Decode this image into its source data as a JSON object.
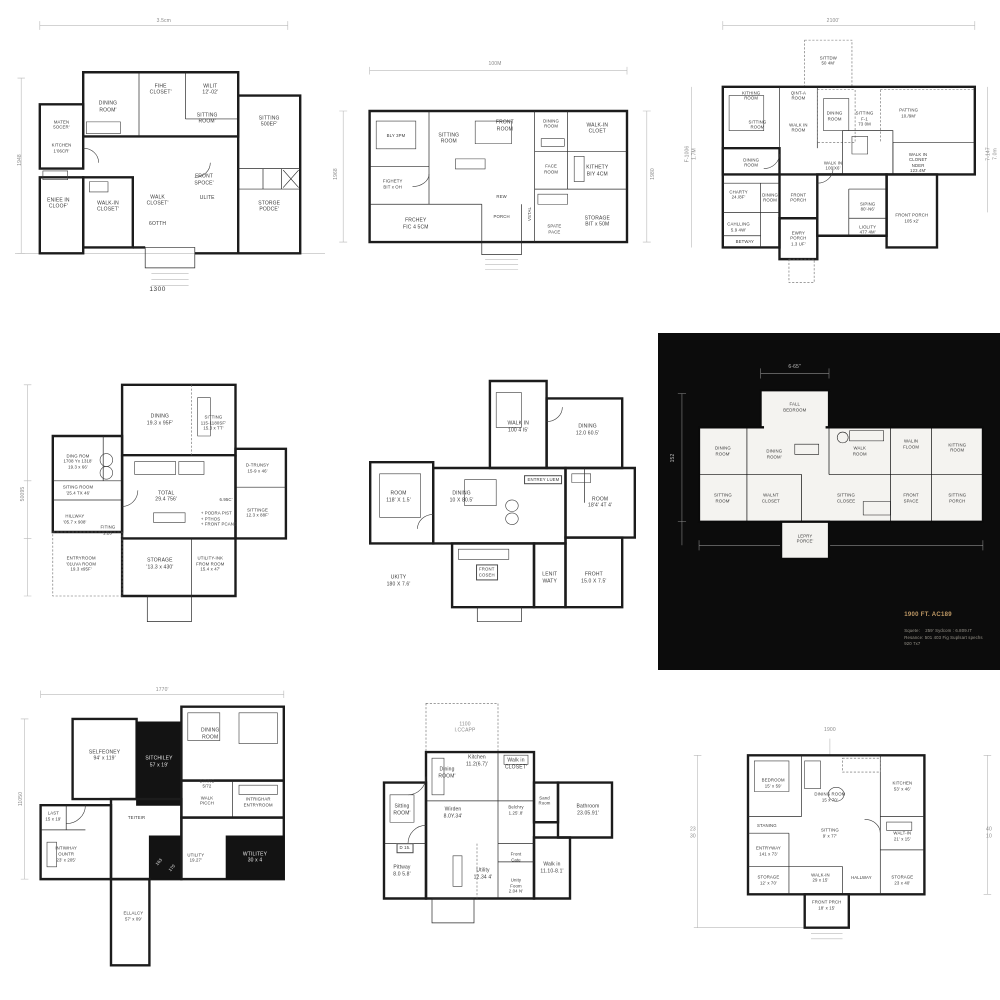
{
  "colors": {
    "ink": "#1c1c1c",
    "paper": "#ffffff",
    "dark_card_bg": "#0c0c0c",
    "dark_caption_accent": "#c09a66"
  },
  "plans": [
    {
      "id": "floorplan-1300",
      "labels": [
        {
          "t": "3.5cm",
          "x": 48,
          "y": 4.5,
          "c": "dim"
        },
        {
          "t": "1948",
          "x": 1.5,
          "y": 52,
          "c": "dim dimv"
        },
        {
          "t": "1300",
          "x": 46,
          "y": 96.5,
          "c": "cap"
        },
        {
          "t": "MATEN\n5OCER'",
          "x": 15,
          "y": 40,
          "c": "sm"
        },
        {
          "t": "KITCHEN\n1'06CR'",
          "x": 15,
          "y": 48,
          "c": "sm"
        },
        {
          "t": "DINING\nROOM'",
          "x": 30,
          "y": 34
        },
        {
          "t": "FIHE\nCLOSET'",
          "x": 47,
          "y": 28
        },
        {
          "t": "WILIT\n12'-02'",
          "x": 63,
          "y": 28
        },
        {
          "t": "SITTING\nROOM'",
          "x": 62,
          "y": 38
        },
        {
          "t": "SITTING\n500EF'",
          "x": 82,
          "y": 39
        },
        {
          "t": "ENIEE IN\nCLOOF'",
          "x": 14,
          "y": 67
        },
        {
          "t": "WALK-IN\nCLOSET'",
          "x": 30,
          "y": 68
        },
        {
          "t": "WALK\nCLOSET'",
          "x": 46,
          "y": 66
        },
        {
          "t": "6OTTH",
          "x": 46,
          "y": 74
        },
        {
          "t": "FRONT\nSPOCE'",
          "x": 61,
          "y": 59
        },
        {
          "t": "ULITE",
          "x": 62,
          "y": 65
        },
        {
          "t": "STORGE\nPODCE'",
          "x": 82,
          "y": 68
        }
      ]
    },
    {
      "id": "floorplan-100m",
      "labels": [
        {
          "t": "100M",
          "x": 50,
          "y": 6.5,
          "c": "dim"
        },
        {
          "t": "1968",
          "x": 1.8,
          "y": 50,
          "c": "dim dimv"
        },
        {
          "t": "1980",
          "x": 98,
          "y": 50,
          "c": "dim dimv"
        },
        {
          "t": "BLY 3PM",
          "x": 20,
          "y": 35,
          "c": "sm"
        },
        {
          "t": "SITTING\nROOM",
          "x": 36,
          "y": 36
        },
        {
          "t": "FRONT\nROOM",
          "x": 53,
          "y": 31
        },
        {
          "t": "DINING\nROOM",
          "x": 67,
          "y": 30,
          "c": "sm"
        },
        {
          "t": "WALK-IN\nCLOET",
          "x": 81,
          "y": 32
        },
        {
          "t": "FIGHETY\nBIT x OH",
          "x": 19,
          "y": 54,
          "c": "sm"
        },
        {
          "t": "FACE\nROOM",
          "x": 67,
          "y": 48,
          "c": "sm"
        },
        {
          "t": "KITHETY\nBIY 4CM",
          "x": 81,
          "y": 49
        },
        {
          "t": "FRCHEY\nFIC 4 5CM",
          "x": 26,
          "y": 70
        },
        {
          "t": "REW",
          "x": 52,
          "y": 59,
          "c": "sm"
        },
        {
          "t": "PORCH",
          "x": 52,
          "y": 67,
          "c": "sm"
        },
        {
          "t": "VSTAL",
          "x": 60.5,
          "y": 66,
          "c": "sm dimv"
        },
        {
          "t": "SPATE\nPACE",
          "x": 68,
          "y": 72,
          "c": "sm"
        },
        {
          "t": "STORAGE\nBIT x 50M",
          "x": 81,
          "y": 69
        }
      ]
    },
    {
      "id": "floorplan-2100",
      "labels": [
        {
          "t": "2100'",
          "x": 47,
          "y": 4.5,
          "c": "dim"
        },
        {
          "t": "F-1006\n1.7M",
          "x": 2,
          "y": 50,
          "c": "dim dimv sm"
        },
        {
          "t": "7-147\n7.0m",
          "x": 97.5,
          "y": 50,
          "c": "dim dimv sm"
        },
        {
          "t": "SITTDW\n50 4M'",
          "x": 45.5,
          "y": 18,
          "c": "sm"
        },
        {
          "t": "KITHING\nROOM",
          "x": 21,
          "y": 30,
          "c": "sm"
        },
        {
          "t": "QINT-A\nROOM",
          "x": 36,
          "y": 30,
          "c": "sm"
        },
        {
          "t": "SITTING\nROOM",
          "x": 23,
          "y": 40,
          "c": "sm"
        },
        {
          "t": "WALK IN\nROOM",
          "x": 36,
          "y": 41,
          "c": "sm"
        },
        {
          "t": "DINING\nROOM",
          "x": 47.5,
          "y": 37,
          "c": "sm"
        },
        {
          "t": "SITTING\nF-1\n73 0M",
          "x": 57,
          "y": 38,
          "c": "sm"
        },
        {
          "t": "PATTING\n10./9M'",
          "x": 71,
          "y": 36,
          "c": "sm"
        },
        {
          "t": "DINING\nROOM",
          "x": 21,
          "y": 53,
          "c": "sm"
        },
        {
          "t": "WALK IN\n100'X6'",
          "x": 47,
          "y": 54,
          "c": "sm"
        },
        {
          "t": "WALK IN\nCLONET\nNDER\n123.4M'",
          "x": 74,
          "y": 53,
          "c": "sm"
        },
        {
          "t": "CHARTY\n24./8F'",
          "x": 17,
          "y": 64,
          "c": "sm"
        },
        {
          "t": "DINING\nROOM",
          "x": 27,
          "y": 65,
          "c": "sm"
        },
        {
          "t": "FRONT\nPORCH",
          "x": 36,
          "y": 65,
          "c": "sm"
        },
        {
          "t": "CAHLLING\n5.9 4W'",
          "x": 17,
          "y": 75,
          "c": "sm"
        },
        {
          "t": "BETWAY",
          "x": 19,
          "y": 80,
          "c": "sm"
        },
        {
          "t": "SIPING\n80'-N6'",
          "x": 58,
          "y": 68,
          "c": "sm"
        },
        {
          "t": "LIOLITY\n477 4M'",
          "x": 58,
          "y": 76,
          "c": "sm"
        },
        {
          "t": "FRONT PORCH\n105 x2'",
          "x": 72,
          "y": 72,
          "c": "sm"
        },
        {
          "t": "EWRY\nPORCH\n1.3 UF'",
          "x": 36,
          "y": 79,
          "c": "sm"
        }
      ]
    },
    {
      "id": "floorplan-total",
      "labels": [
        {
          "t": "50095",
          "x": 2.5,
          "y": 48,
          "c": "dim dimv"
        },
        {
          "t": "DINING\n19.3 x 95F'",
          "x": 46,
          "y": 25
        },
        {
          "t": "SITTING\n115-1180SF'\n15.3 x TT'",
          "x": 63,
          "y": 26,
          "c": "sm"
        },
        {
          "t": "DING ROM\n1708 Yx 1318'\n19.3 x 66'",
          "x": 20,
          "y": 38,
          "c": "sm"
        },
        {
          "t": "SITING ROOM\n'25.4 TX 46'",
          "x": 20,
          "y": 47,
          "c": "sm"
        },
        {
          "t": "HILLWAY\n'05.7 x 908'",
          "x": 19,
          "y": 56,
          "c": "sm"
        },
        {
          "t": "FITING\n1.23'",
          "x": 29.5,
          "y": 59.5,
          "c": "sm"
        },
        {
          "t": "TOTAL\n29.4 756'",
          "x": 48,
          "y": 49
        },
        {
          "t": "6.95C'",
          "x": 67,
          "y": 50,
          "c": "sm"
        },
        {
          "t": "+ PODRA PIST\n+ PTHOS\n+ FRONT PCANS",
          "x": 59,
          "y": 56,
          "c": "sm left"
        },
        {
          "t": "D-TRUNSY\n15-9 x 46'",
          "x": 77,
          "y": 40,
          "c": "sm"
        },
        {
          "t": "SITTINGE\n12.3 x 88F'",
          "x": 77,
          "y": 54,
          "c": "sm"
        },
        {
          "t": "ENTRYROOM\n'01UVA ROOM\n19.3 x95F'",
          "x": 21,
          "y": 70,
          "c": "sm"
        },
        {
          "t": "STORAGE\n'13.3 x 430'",
          "x": 46,
          "y": 70
        },
        {
          "t": "UTILITY-INK\nFROM ROOM\n15.4 x 47'",
          "x": 62,
          "y": 70,
          "c": "sm"
        }
      ]
    },
    {
      "id": "floorplan-entrey-luem",
      "labels": [
        {
          "t": "WALK IN\n100 4 I5'",
          "x": 55,
          "y": 26
        },
        {
          "t": "DINING\n12.0 60.5'",
          "x": 77,
          "y": 27
        },
        {
          "t": "ROOM\n118' X 1.5'",
          "x": 17,
          "y": 50
        },
        {
          "t": "DINING\n10 X 80.5'",
          "x": 37,
          "y": 50
        },
        {
          "t": "ENTREY LUEM",
          "x": 63,
          "y": 44,
          "c": "box sm"
        },
        {
          "t": "ROOM\n18'4' 4T 4'",
          "x": 81,
          "y": 52
        },
        {
          "t": "FRONT\nCOSEH",
          "x": 45,
          "y": 76,
          "c": "box sm"
        },
        {
          "t": "LENIT\nWATY",
          "x": 65,
          "y": 78
        },
        {
          "t": "FROHT\n15.0 X 7.5'",
          "x": 79,
          "y": 78
        },
        {
          "t": "UKITY\n180 X 7.6'",
          "x": 17,
          "y": 79
        }
      ]
    },
    {
      "id": "floorplan-1900-dark",
      "labels": [
        {
          "t": "6-65''",
          "x": 40,
          "y": 10,
          "c": "dim6"
        },
        {
          "t": "152",
          "x": 4.5,
          "y": 37,
          "c": "dim6 dimv"
        },
        {
          "t": "FALL\nBEDROOM",
          "x": 40,
          "y": 22,
          "c": "sm"
        },
        {
          "t": "DINING\nROOM'",
          "x": 19,
          "y": 35,
          "c": "sm"
        },
        {
          "t": "DINING\nROOM'",
          "x": 34,
          "y": 36,
          "c": "sm"
        },
        {
          "t": "WALK\nROOM",
          "x": 59,
          "y": 35,
          "c": "sm"
        },
        {
          "t": "WALIN\nFLOOM",
          "x": 74,
          "y": 33,
          "c": "sm"
        },
        {
          "t": "KITTING\nROOM",
          "x": 87.5,
          "y": 34,
          "c": "sm"
        },
        {
          "t": "SITTING\nROOM'",
          "x": 19,
          "y": 49,
          "c": "sm"
        },
        {
          "t": "WALNT\nCLOSET",
          "x": 33,
          "y": 49,
          "c": "sm"
        },
        {
          "t": "SITTING\nCLOSEE",
          "x": 55,
          "y": 49,
          "c": "sm"
        },
        {
          "t": "FRONT\nSPACE",
          "x": 74,
          "y": 49,
          "c": "sm"
        },
        {
          "t": "SITTING\nPORCH",
          "x": 87.5,
          "y": 49,
          "c": "sm"
        },
        {
          "t": "LEPRY\nPORCE'",
          "x": 43,
          "y": 61,
          "c": "sm"
        },
        {
          "t": "1900 FT. AC189",
          "x": 72,
          "y": 84,
          "c": "ttl"
        },
        {
          "t": "Squete:    259' Sydcom : 6.809.IT\nResance: 501 403 Fig Suplsart spechs\n920 7x7",
          "x": 72,
          "y": 90.5,
          "c": "txt"
        }
      ]
    },
    {
      "id": "floorplan-1770",
      "labels": [
        {
          "t": "1770'",
          "x": 46,
          "y": 2.5,
          "c": "dim"
        },
        {
          "t": "11050",
          "x": 1.8,
          "y": 38,
          "c": "dim dimv"
        },
        {
          "t": "SELFEONEY\n94' x 119'",
          "x": 28,
          "y": 24
        },
        {
          "t": "SITCHILEY\n57 x 19'",
          "x": 45,
          "y": 26,
          "c": "wht"
        },
        {
          "t": "DINING\nROOM",
          "x": 61,
          "y": 17
        },
        {
          "t": "SITING\n5/72",
          "x": 60,
          "y": 33,
          "c": "sm"
        },
        {
          "t": "WALK\nPICCH",
          "x": 60,
          "y": 38.5,
          "c": "sm"
        },
        {
          "t": "LAST\n15 x 19'",
          "x": 12,
          "y": 43.5,
          "c": "sm"
        },
        {
          "t": "INTIWHAY\nOUNTR\n23' x 205'",
          "x": 16,
          "y": 56,
          "c": "sm"
        },
        {
          "t": "TEITEIR",
          "x": 38,
          "y": 44,
          "c": "sm"
        },
        {
          "t": "UTILITY\n19.27'",
          "x": 56.5,
          "y": 57,
          "c": "sm"
        },
        {
          "t": "163",
          "x": 45,
          "y": 58.5,
          "c": "sm wht diag"
        },
        {
          "t": "170",
          "x": 49,
          "y": 60.5,
          "c": "sm wht diag"
        },
        {
          "t": "INTRIGHAR\nENTRYROOM",
          "x": 76,
          "y": 39,
          "c": "sm"
        },
        {
          "t": "WTILITEY\n30 x 4",
          "x": 75,
          "y": 57,
          "c": "wht"
        },
        {
          "t": "ELLALCY\n57' x 09'",
          "x": 37,
          "y": 76,
          "c": "sm"
        }
      ]
    },
    {
      "id": "floorplan-1100",
      "labels": [
        {
          "t": "1100\nI.CCAPP",
          "x": 35,
          "y": 14,
          "c": "sm dim"
        },
        {
          "t": "Dining\nROOM'",
          "x": 29,
          "y": 29
        },
        {
          "t": "Kitchen\n11.2(6.7)'",
          "x": 39,
          "y": 25
        },
        {
          "t": "Walk in\nCLOSET'",
          "x": 52,
          "y": 26
        },
        {
          "t": "Sitting\nROOM'",
          "x": 14,
          "y": 41
        },
        {
          "t": "Wirden\n8.0Y.34'",
          "x": 31,
          "y": 42
        },
        {
          "t": "Belchry\n1.25'.8'",
          "x": 52,
          "y": 41,
          "c": "sm"
        },
        {
          "t": "Sand\nRoom",
          "x": 61.5,
          "y": 38,
          "c": "sm"
        },
        {
          "t": "Bathroom\n23.05.91'",
          "x": 76,
          "y": 41
        },
        {
          "t": "D 15.",
          "x": 15,
          "y": 53.5,
          "c": "sm box"
        },
        {
          "t": "Pittway\n8.0 5.8'",
          "x": 14,
          "y": 61
        },
        {
          "t": "Utility\n12.34 4'",
          "x": 41,
          "y": 62
        },
        {
          "t": "Front\nCate",
          "x": 52,
          "y": 56.5,
          "c": "sm"
        },
        {
          "t": "Unity\nFoom\n2.04 N'",
          "x": 52,
          "y": 66,
          "c": "sm"
        },
        {
          "t": "Walk in\n11.10-8.1'",
          "x": 64,
          "y": 60
        }
      ]
    },
    {
      "id": "floorplan-1900",
      "labels": [
        {
          "t": "1900",
          "x": 46,
          "y": 3,
          "c": "dim"
        },
        {
          "t": "23\n30",
          "x": 2.5,
          "y": 40,
          "c": "dim"
        },
        {
          "t": "40\n10",
          "x": 96.5,
          "y": 40,
          "c": "dim"
        },
        {
          "t": "BEDROOM\n15' x 59'",
          "x": 28,
          "y": 22,
          "c": "sm"
        },
        {
          "t": "DINING ROOM\n15 x 70'",
          "x": 46,
          "y": 27,
          "c": "sm"
        },
        {
          "t": "KITCHEN\n53' x 46'",
          "x": 69,
          "y": 23,
          "c": "sm"
        },
        {
          "t": "STANING",
          "x": 26,
          "y": 37.5,
          "c": "sm"
        },
        {
          "t": "SITTING\n9' x 77'",
          "x": 46,
          "y": 40,
          "c": "sm"
        },
        {
          "t": "WALT-IN\n21' x 15'",
          "x": 69,
          "y": 41,
          "c": "sm"
        },
        {
          "t": "ENTRYWAY\n141 x 73'",
          "x": 26.5,
          "y": 46.5,
          "c": "sm"
        },
        {
          "t": "STORAGE\n12' x 70'",
          "x": 26.5,
          "y": 57,
          "c": "sm"
        },
        {
          "t": "WALK-IN\n29 x 15'",
          "x": 43,
          "y": 56,
          "c": "sm"
        },
        {
          "t": "HALLWAY",
          "x": 56,
          "y": 56,
          "c": "sm"
        },
        {
          "t": "STORAGE\n23 x 40'",
          "x": 69,
          "y": 57,
          "c": "sm"
        },
        {
          "t": "FRONT PRCH\n18' x 15'",
          "x": 45,
          "y": 66,
          "c": "sm"
        }
      ]
    }
  ]
}
